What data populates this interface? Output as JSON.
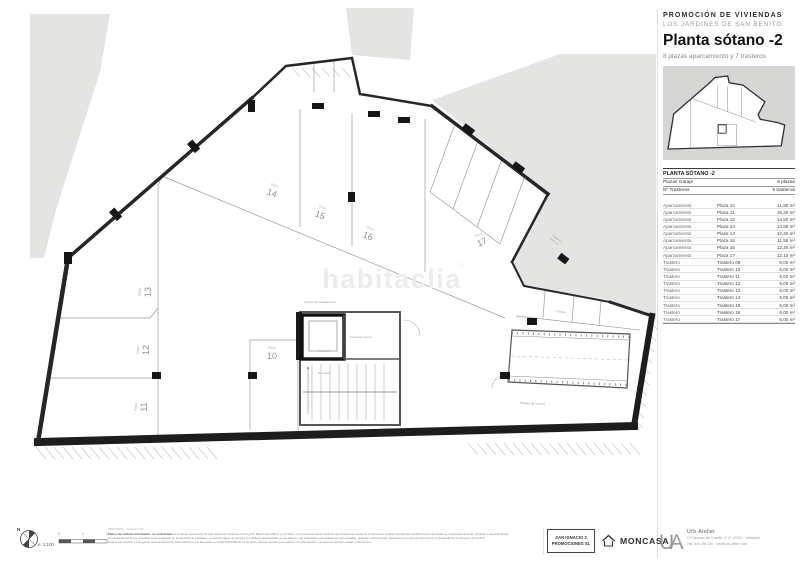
{
  "header": {
    "eyebrow": "PROMOCIÓN DE VIVIENDAS",
    "project": "LOS JARDINES DE SAN BENITO",
    "title": "Planta sótano -2",
    "subtitle": "8 plazas aparcamiento y 7 trasteros"
  },
  "table": {
    "title": "PLANTA SÓTANO -2",
    "summary": [
      {
        "label": "Plazas Garaje",
        "value": "8 plazas"
      },
      {
        "label": "Nº Trasteros",
        "value": "9 trasteros"
      }
    ],
    "rows": [
      {
        "type": "Aparcamiento",
        "name": "Plaza 10",
        "area": "11,80 m²"
      },
      {
        "type": "Aparcamiento",
        "name": "Plaza 11",
        "area": "15,30 m²"
      },
      {
        "type": "Aparcamiento",
        "name": "Plaza 12",
        "area": "14,50 m²"
      },
      {
        "type": "Aparcamiento",
        "name": "Plaza 13",
        "area": "14,65 m²"
      },
      {
        "type": "Aparcamiento",
        "name": "Plaza 14",
        "area": "12,20 m²"
      },
      {
        "type": "Aparcamiento",
        "name": "Plaza 15",
        "area": "11,55 m²"
      },
      {
        "type": "Aparcamiento",
        "name": "Plaza 16",
        "area": "12,20 m²"
      },
      {
        "type": "Aparcamiento",
        "name": "Plaza 17",
        "area": "12,15 m²"
      },
      {
        "type": "Trastero",
        "name": "Trastero 09",
        "area": "6,00 m²"
      },
      {
        "type": "Trastero",
        "name": "Trastero 10",
        "area": "6,00 m²"
      },
      {
        "type": "Trastero",
        "name": "Trastero 11",
        "area": "6,00 m²"
      },
      {
        "type": "Trastero",
        "name": "Trastero 12",
        "area": "6,00 m²"
      },
      {
        "type": "Trastero",
        "name": "Trastero 13",
        "area": "6,00 m²"
      },
      {
        "type": "Trastero",
        "name": "Trastero 14",
        "area": "6,00 m²"
      },
      {
        "type": "Trastero",
        "name": "Trastero 15",
        "area": "6,00 m²"
      },
      {
        "type": "Trastero",
        "name": "Trastero 16",
        "area": "6,00 m²"
      },
      {
        "type": "Trastero",
        "name": "Trastero 17",
        "area": "6,00 m²"
      }
    ]
  },
  "plan": {
    "watermark": "habitaclia",
    "watermark_r": "®",
    "plaza_word": "Plaza",
    "numbers": {
      "p10": "10",
      "p11": "11",
      "p12": "12",
      "p13": "13",
      "p14": "14",
      "p15": "15",
      "p16": "16",
      "p17": "17"
    },
    "rooms": {
      "instalaciones": "Cuarto de instalaciones",
      "vestibulo": "Vestíbulo previo",
      "escalera": "Escalera",
      "rampa": "Rampa de acceso",
      "trastero": "Trastero",
      "trastero_area": "6,00 m²"
    }
  },
  "footer": {
    "version": "06/07/2020 - Versión V.07",
    "disclaimer_lead": "Planos de carácter informativo, no contractual.",
    "disclaimer_1": "El presente documento ha sido elaborado conforme al Proyecto Básico del edificio y, por tanto, el promotor/vendedor advierte que durante las obras de construcción podrían introducirse modificaciones derivadas de exigencias técnicas, jurídicas o administrativas.",
    "disclaimer_2": "El equipamiento de las viviendas será el indicado en la memoria de calidades, no siendo objeto de entrega el mobiliario representado en los planos. Las superficies expresadas son aproximadas, pudiendo experimentar variaciones por razones técnicas en el desarrollo de la ejecución de la obra.",
    "disclaimer_3": "Toda la información y entrega de documentación se hará conforme a lo dispuesto en el RD 515/1989 de 21 de abril y demás normas que pudieran complementarlo, ya sean de carácter estatal o autonómico.",
    "scale": "e: 1:100",
    "ticks": [
      "0",
      "1",
      "2"
    ],
    "north": "N",
    "developer_line1": "SAN IGNACIO 3",
    "developer_line2": "PROMOCIONES SL",
    "builder": "MONCASA",
    "ua": "UA",
    "studio_name": "Urb·Atelier",
    "studio_address": "C/ Cánovas del Castillo, 4, 4º, 47002 · Valladolid",
    "studio_contact": "Telf. 640 258 330 · info@urb-atelier.com"
  }
}
